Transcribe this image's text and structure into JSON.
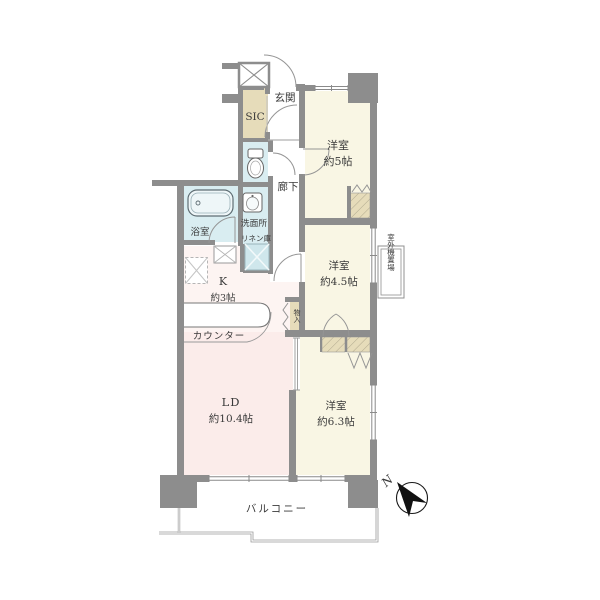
{
  "labels": {
    "entrance": "玄関",
    "shoe_closet": "SIC",
    "room5_name": "洋室",
    "room5_size": "約5帖",
    "hallway": "廊下",
    "bathroom": "浴室",
    "washroom": "洗面所",
    "linen_closet": "リネン庫",
    "kitchen_name": "K",
    "kitchen_size": "約3帖",
    "counter": "カウンター",
    "storage": "物入",
    "room45_name": "洋室",
    "room45_size": "約4.5帖",
    "outdoor_unit": "室外機置場",
    "ld_name": "LD",
    "ld_size": "約10.4帖",
    "room63_name": "洋室",
    "room63_size": "約6.3帖",
    "balcony": "バルコニー",
    "compass_north": "N"
  },
  "colors": {
    "wall": "#8d8d8d",
    "room_cream": "#f9f6e4",
    "living_pink": "#fbecea",
    "kitchen_pink": "#fdf4f2",
    "wet_area_blue": "#d9edf1",
    "closet_beige": "#e6dcba"
  },
  "icons": [
    "bathtub-icon",
    "toilet-icon",
    "vanity-sink-icon",
    "kitchen-sink-icon",
    "stove-icon",
    "north-arrow-icon",
    "washing-machine-box",
    "refrigerator-box",
    "pipe-space-box"
  ]
}
